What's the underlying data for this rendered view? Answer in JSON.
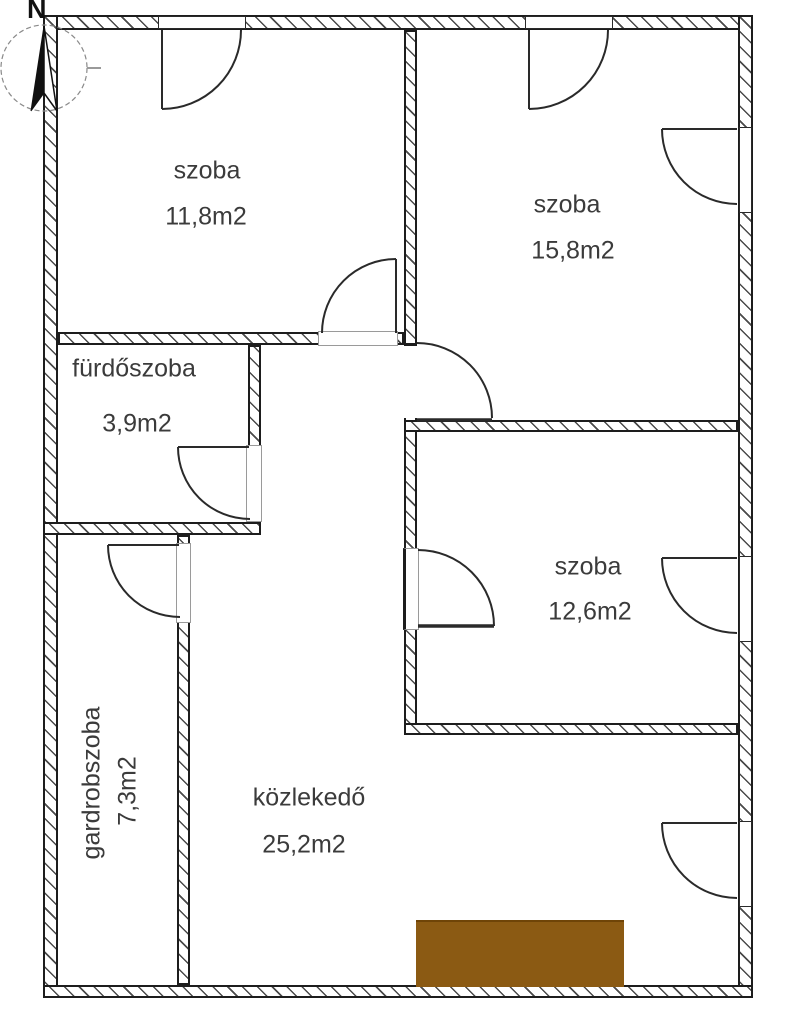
{
  "title": "floor-plan",
  "compass": {
    "north_label": "N"
  },
  "rooms": [
    {
      "id": "szoba-top-left",
      "name": "szoba",
      "area": "11,8m2"
    },
    {
      "id": "szoba-top-right",
      "name": "szoba",
      "area": "15,8m2"
    },
    {
      "id": "furdoszoba",
      "name": "fürdőszoba",
      "area": "3,9m2"
    },
    {
      "id": "szoba-mid-right",
      "name": "szoba",
      "area": "12,6m2"
    },
    {
      "id": "gardrobszoba",
      "name": "gardrobszoba",
      "area": "7,3m2"
    },
    {
      "id": "kozlekedo",
      "name": "közlekedő",
      "area": "25,2m2"
    }
  ],
  "colors": {
    "entrance_marker": "#8b5a13",
    "wall_line": "#1d1d1d"
  }
}
